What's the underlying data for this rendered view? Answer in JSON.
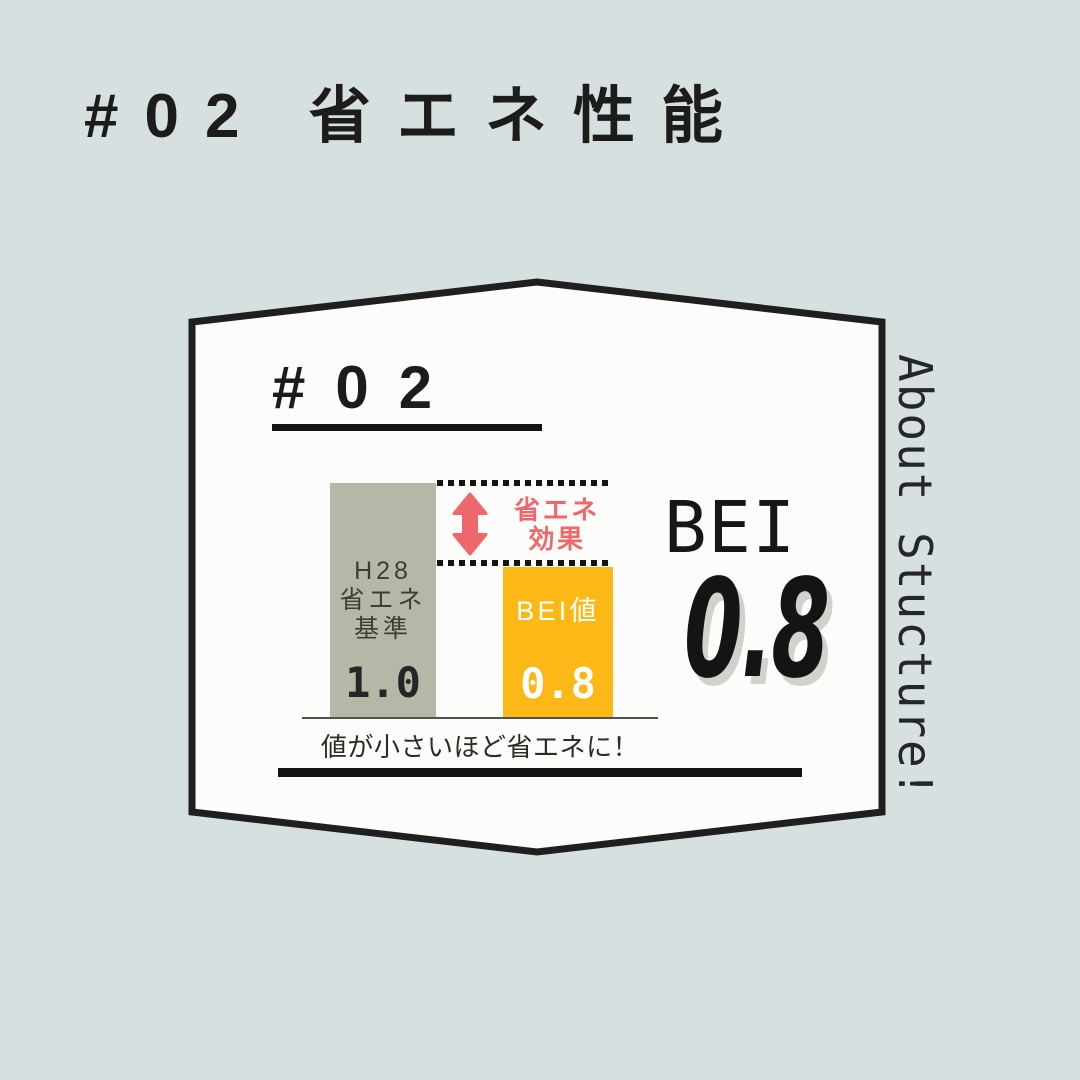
{
  "poster": {
    "header_title": "#02 省エネ性能",
    "side_label": "About Stucture!",
    "card_number": "#02",
    "result_label": "BEI",
    "result_value": "0.8"
  },
  "chart_data": {
    "type": "bar",
    "categories": [
      "H28省エネ基準",
      "BEI値"
    ],
    "values": [
      1.0,
      0.8
    ],
    "ylim": [
      0,
      1.0
    ],
    "grid": false,
    "value_axis_hidden": true,
    "bars": [
      {
        "label_lines": [
          "H28",
          "省エネ",
          "基準"
        ],
        "value_label": "1.0",
        "color": "#b6b7a7"
      },
      {
        "label_lines": [
          "BEI値"
        ],
        "value_label": "0.8",
        "color": "#fbb817"
      }
    ],
    "annotation_lines": [
      "省エネ",
      "効果"
    ],
    "note": "値が小さいほど省エネに！"
  },
  "colors": {
    "background": "#d6e0e1",
    "card_fill": "#fcfcfa",
    "card_border": "#1f1f1f",
    "bar_standard": "#b6b7a7",
    "bar_bei": "#fbb817",
    "accent_red": "#ee676b",
    "text_dark": "#1c1c1a",
    "bar_text_light": "#ffffff"
  }
}
